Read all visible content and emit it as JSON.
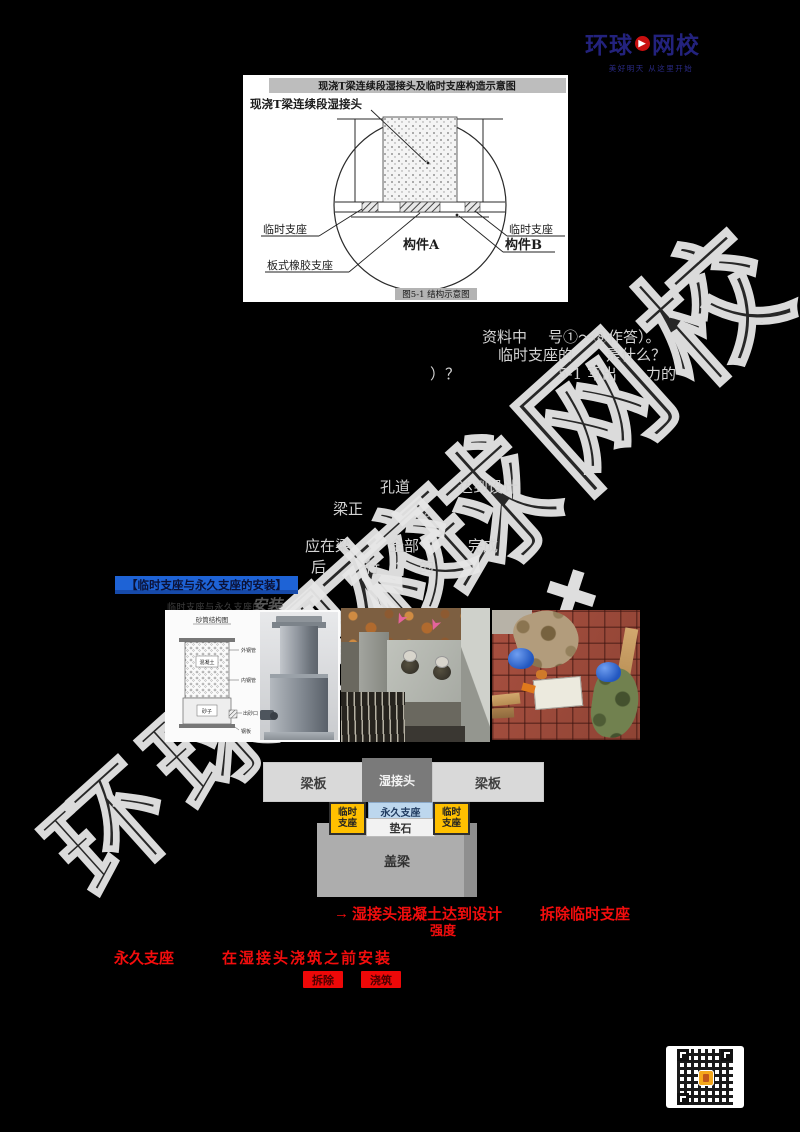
{
  "page": {
    "background": "#000000"
  },
  "watermark": {
    "text": "环球网校",
    "color": "#e7e7e7"
  },
  "logo": {
    "part1": "环球",
    "part2": "网校",
    "play_icon": "▶",
    "tagline": "美好明天 从这里开始",
    "navy": "#23227d",
    "red": "#c90f0f"
  },
  "figure1": {
    "title": "现浇T梁连续段湿接头及临时支座构造示意图",
    "caption": "图5-1 结构示意图",
    "labels": {
      "wet_joint": "现浇T梁连续段湿接头",
      "temp_left": "临时支座",
      "temp_right": "临时支座",
      "rubber_bearing": "板式橡胶支座",
      "component_a": "构件A",
      "component_b": "构件B"
    }
  },
  "fragments": [
    {
      "text": "资料中",
      "x": 482,
      "y": 329
    },
    {
      "text": "号①～⑧作答）。",
      "x": 548,
      "y": 329
    },
    {
      "text": "临时支座的",
      "x": 498,
      "y": 347
    },
    {
      "text": "是什么？",
      "x": 606,
      "y": 347
    },
    {
      "text": "）？",
      "x": 430,
      "y": 366
    },
    {
      "text": "5-1 写出",
      "x": 558,
      "y": 366
    },
    {
      "text": "力的",
      "x": 646,
      "y": 366
    },
    {
      "text": "孔道",
      "x": 380,
      "y": 479
    },
    {
      "text": "达到设计",
      "x": 458,
      "y": 479
    },
    {
      "text": "梁正",
      "x": 333,
      "y": 501
    },
    {
      "text": "。",
      "x": 424,
      "y": 503
    },
    {
      "text": "应在梁",
      "x": 305,
      "y": 538
    },
    {
      "text": "全部",
      "x": 389,
      "y": 538
    },
    {
      "text": "完成",
      "x": 468,
      "y": 538
    },
    {
      "text": "后",
      "x": 311,
      "y": 559
    },
    {
      "text": "行",
      "x": 365,
      "y": 559
    },
    {
      "text": "的",
      "x": 419,
      "y": 559
    },
    {
      "text": "→",
      "x": 334,
      "y": 906,
      "cls": "red",
      "size": 15
    },
    {
      "text": "湿接头混凝土达到设计",
      "x": 352,
      "y": 907,
      "cls": "red",
      "size": 15
    },
    {
      "text": "拆除临时支座",
      "x": 540,
      "y": 907,
      "cls": "red",
      "size": 15
    },
    {
      "text": "强度",
      "x": 430,
      "y": 924,
      "cls": "red",
      "size": 13
    },
    {
      "text": "永久支座",
      "x": 114,
      "y": 951,
      "cls": "red",
      "size": 15
    },
    {
      "text": "在湿接头浇筑之前安装",
      "x": 222,
      "y": 951,
      "cls": "red",
      "size": 15,
      "ls": 2
    }
  ],
  "section": {
    "banner": "【临时支座与永久支座的安装】",
    "subheading_prefix": "临时支座与永久支座的",
    "subheading_emph": "安装",
    "banner_bg": "#1e63d6"
  },
  "sand_diagram": {
    "title": "砂筒结构图",
    "outer_tube": "外钢管",
    "concrete": "混凝土",
    "inner_tube": "内钢管",
    "sand": "砂子",
    "outlet": "出砂口",
    "plate": "钢板"
  },
  "schematic": {
    "beam_left": "梁板",
    "wet_joint": "湿接头",
    "beam_right": "梁板",
    "temp_support_left": "临时支座",
    "perm_support": "永久支座",
    "pad_stone": "垫石",
    "temp_support_right": "临时支座",
    "cap_beam": "盖梁",
    "temp_color": "#FFC000",
    "perm_color": "#BDD7EE"
  },
  "notes": {
    "tag1": "拆除",
    "tag2": "浇筑",
    "red": "#f30d0d"
  }
}
